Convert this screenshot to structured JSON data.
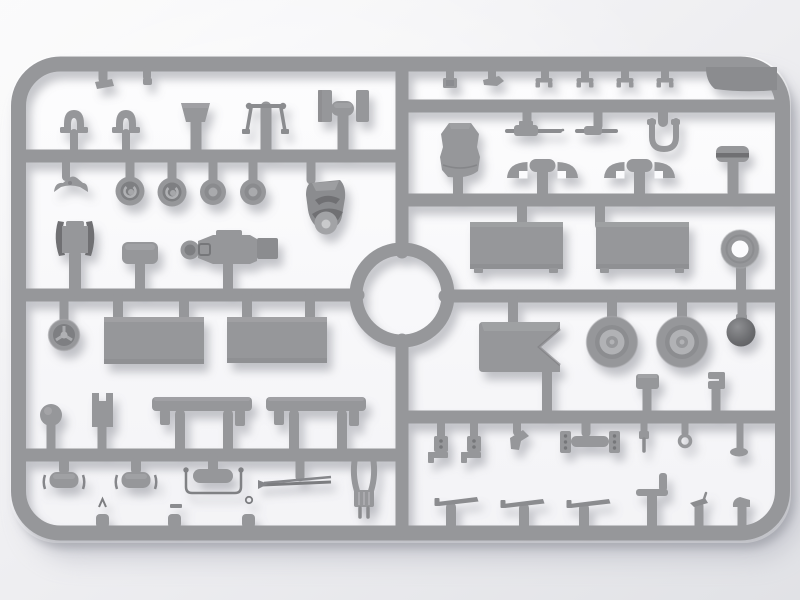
{
  "scene": {
    "type": "product-photo",
    "description": "Top-down studio photograph of an unpainted light-gray injection-molded plastic model kit sprue (parts frame) full of small vehicle parts, on a soft white backdrop",
    "text_visible": "none",
    "lighting": "soft top light, parts cast small soft shadows down-right"
  },
  "colors": {
    "plastic": "#96979a",
    "plastic_mid": "#8b8c8f",
    "plastic_dark": "#6f7073",
    "plastic_light": "#b4b5b8",
    "plastic_hub": "#b1b2b5",
    "backdrop": "#fbfbfd",
    "bg_light": "#fafafb",
    "bg_dark": "#e1e2e6",
    "shadow": "#7f808a"
  },
  "sprue": {
    "material": "light gray polystyrene",
    "frame": "rounded rectangle runner frame with a circular ring opening at its center",
    "left_half": {
      "row_1": [
        "two small arched clamps",
        "trapezoid seat back",
        "tow bar with ball-ended cross handle",
        "two flat straps flanking a capped post"
      ],
      "row_2": [
        "curved spring bracket",
        "four round wheel hubs",
        "armored mount with dark visor crescents",
        "radiator with dark side rails",
        "rounded base plate",
        "machine-gun receiver with ring bezel"
      ],
      "row_3": [
        "three-spoke steering wheel",
        "two large flat cargo panels",
        "round knob",
        "notched block",
        "two bench seats with legs"
      ],
      "row_4": [
        "two capped posts with side spring ticks",
        "grab handle with wire bail",
        "thin twin blades with arrow tip",
        "fork mount with twin pins",
        "tiny relief marks: A, dash, O"
      ]
    },
    "right_half": {
      "row_1": [
        "small ribbed square clip",
        "flat arrow clip",
        "four staple brackets",
        "wide blanking plate at corner"
      ],
      "row_2": [
        "rounded engine cowl",
        "two machine guns",
        "U-shaped tow shackle",
        "capped tank piece",
        "four quarter wheel-arch fenders on two T-posts"
      ],
      "row_3": [
        "two large flat cargo panels",
        "spare tyre ring"
      ],
      "row_4": [
        "V-notched gun cradle box",
        "two road wheels with light hubs",
        "dark ball mount",
        "small box",
        "small channel clip"
      ],
      "row_5": [
        "two drilled pedal brackets",
        "bent lever plate",
        "drilled coupler with twin plates",
        "small pin",
        "small ring",
        "small oval pad",
        "three thin stay levers",
        "L-shaped rod",
        "small hook",
        "small wedge"
      ]
    },
    "center_feature": "circular runner ring joining the two halves"
  }
}
